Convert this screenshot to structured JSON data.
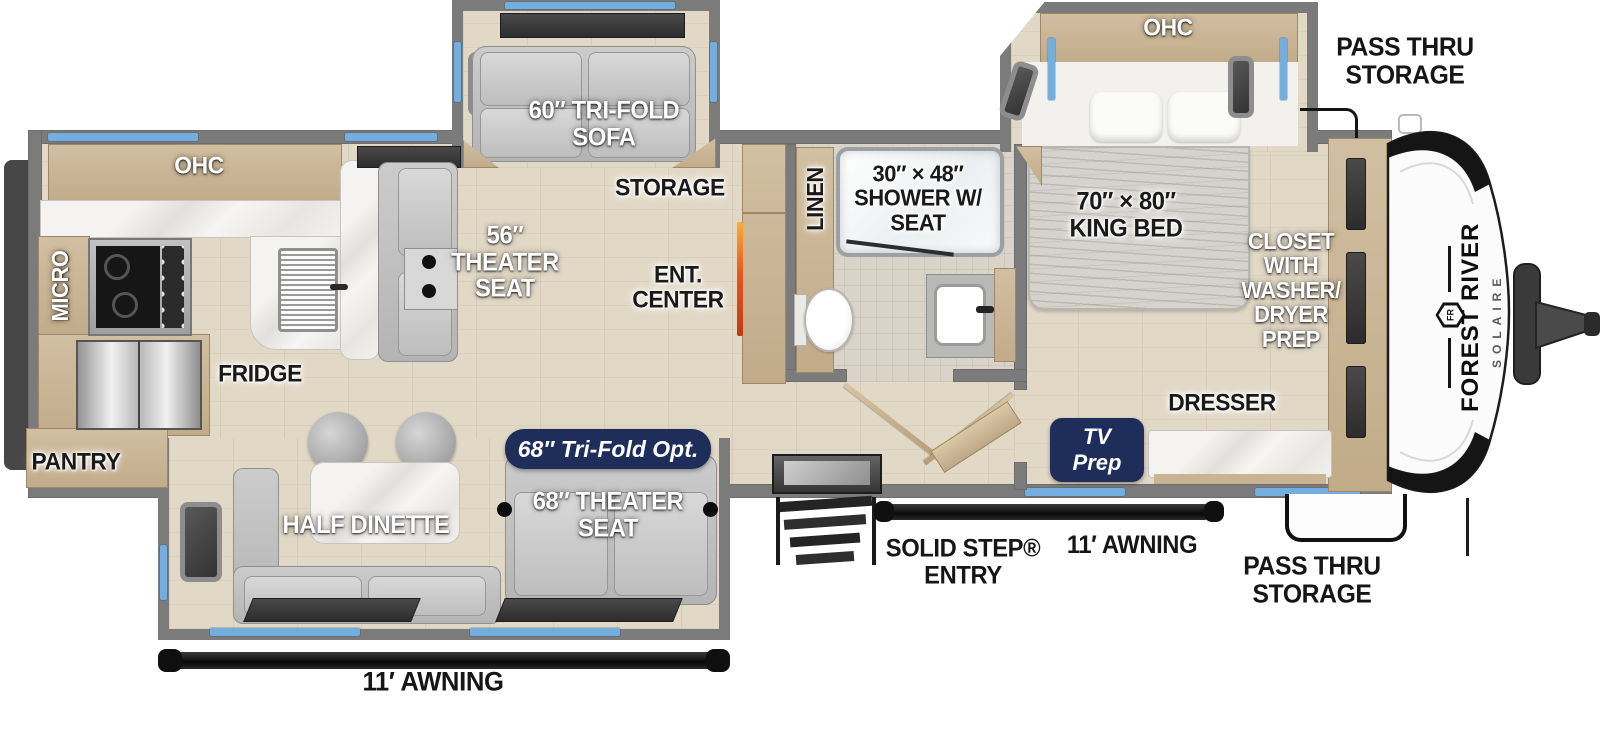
{
  "title": "Forest River Solaire travel trailer floor plan",
  "brand": {
    "name": "FOREST RIVER",
    "model": "SOLAIRE",
    "monogram": "FR"
  },
  "labels": {
    "pass_thru_top": "PASS THRU\nSTORAGE",
    "ohc_bedroom": "OHC",
    "sofa": "60″ TRI-FOLD\nSOFA",
    "storage": "STORAGE",
    "linen": "LINEN",
    "shower": "30″ × 48″\nSHOWER W/\nSEAT",
    "king_bed": "70″ × 80″\nKING BED",
    "closet": "CLOSET\nWITH\nWASHER/\nDRYER\nPREP",
    "ohc_kitchen": "OHC",
    "micro": "MICRO",
    "theater_56": "56″\nTHEATER\nSEAT",
    "ent_center": "ENT.\nCENTER",
    "fridge": "FRIDGE",
    "pantry": "PANTRY",
    "dresser": "DRESSER",
    "tv_prep": "TV\nPrep",
    "tri_fold_opt": "68″ Tri-Fold Opt.",
    "theater_68": "68″ THEATER\nSEAT",
    "half_dinette": "HALF DINETTE",
    "solid_step": "SOLID STEP®\nENTRY",
    "awning_right": "11′ AWNING",
    "pass_thru_bottom": "PASS THRU\nSTORAGE",
    "awning_bottom": "11′ AWNING"
  },
  "colors": {
    "accent_navy": "#1f2d5a",
    "window_blue": "#74aede",
    "wall_gray": "#7b7b7b",
    "floor_tan": "#e2d8c6",
    "cabinet_tan": "#c8b394",
    "awning_black": "#1b1b1b",
    "fireplace_orange": "#e8561f"
  }
}
